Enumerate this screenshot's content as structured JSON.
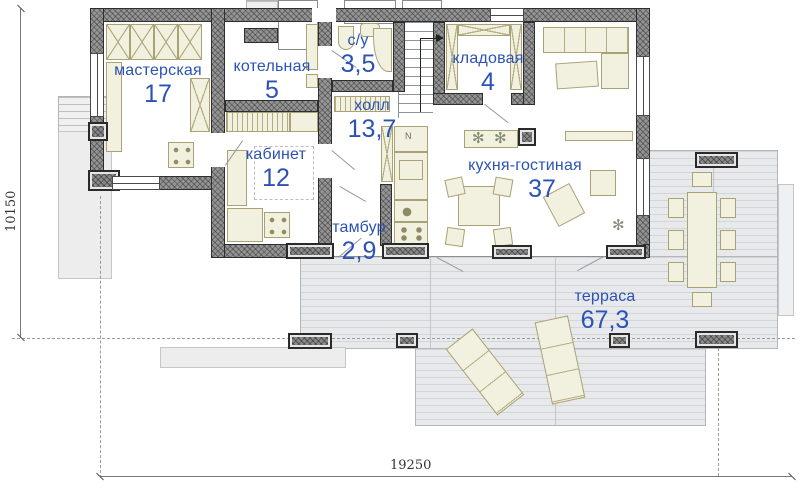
{
  "plan": {
    "rooms": [
      {
        "name": "мастерская",
        "area": "17"
      },
      {
        "name": "котельная",
        "area": "5"
      },
      {
        "name": "с/у",
        "area": "3,5"
      },
      {
        "name": "кладовая",
        "area": "4"
      },
      {
        "name": "холл",
        "area": "13,7"
      },
      {
        "name": "кабинет",
        "area": "12"
      },
      {
        "name": "кухня-гостиная",
        "area": "37"
      },
      {
        "name": "тамбур",
        "area": "2,9"
      },
      {
        "name": "терраса",
        "area": "67,3"
      }
    ],
    "dimensions": {
      "bottom": "19250",
      "left": "10150"
    },
    "colors": {
      "label_blue": "#2b52b4",
      "wall_gray": "#949494",
      "furniture_cream": "#f2f0de",
      "deck_gray": "#e7e9eb"
    },
    "icons": {
      "fridge": "N",
      "plant": "✻"
    }
  }
}
